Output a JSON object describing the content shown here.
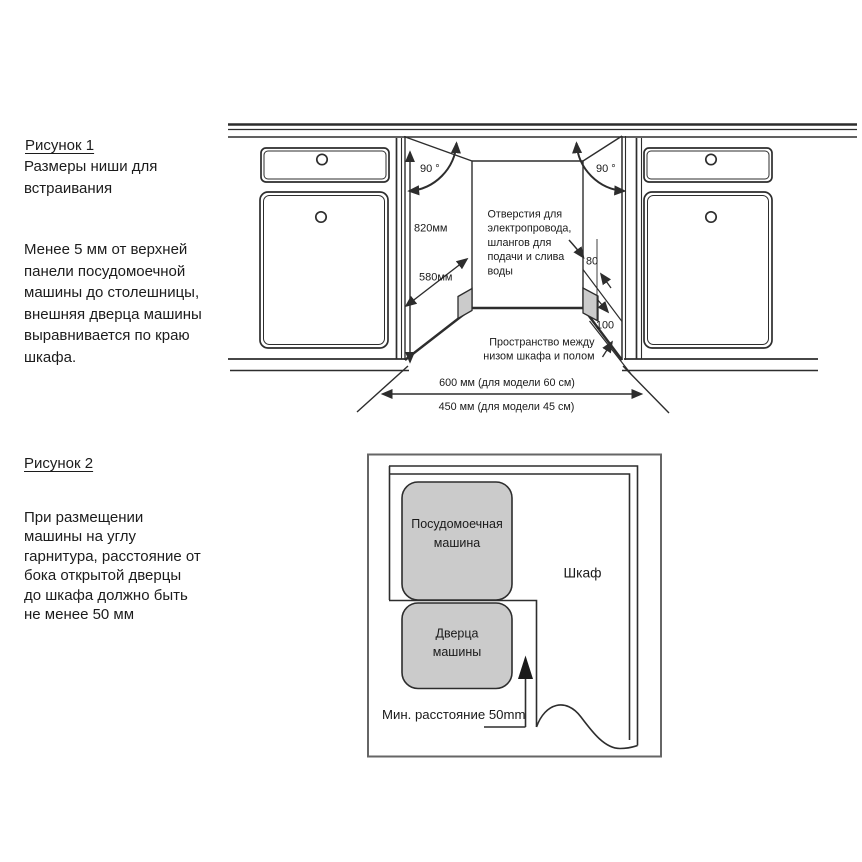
{
  "figure1": {
    "title": "Рисунок 1",
    "subtitle": [
      "Размеры ниши для",
      "встраивания"
    ],
    "caption": [
      "Менее 5 мм от верхней",
      "панели посудомоечной",
      "машины до столешницы,",
      "внешняя дверца машины",
      "выравнивается по краю",
      "шкафа."
    ],
    "angle_left": "90 °",
    "angle_right": "90 °",
    "dim_height": "820мм",
    "dim_depth": "580мм",
    "holes_note": [
      "Отверстия для",
      "электропровода,",
      "шлангов для",
      "подачи и слива",
      "воды"
    ],
    "dim_80": "80",
    "dim_100": "100",
    "floor_note": [
      "Пространство между",
      "низом шкафа и полом"
    ],
    "dim_600": "600 мм (для модели 60 см)",
    "dim_450": "450 мм (для модели 45 см)"
  },
  "figure2": {
    "title": "Рисунок 2",
    "caption": [
      "При размещении",
      "машины на углу",
      "гарнитура, расстояние от",
      "бока открытой дверцы",
      "до шкафа должно быть",
      "не менее 50 мм"
    ],
    "dishwasher": [
      "Посудомоечная",
      "машина"
    ],
    "door": [
      "Дверца",
      "машины"
    ],
    "cabinet": "Шкаф",
    "min_distance": "Мин. расстояние 50mm"
  },
  "colors": {
    "line": "#2d2d2d",
    "gray_fill": "#cbcbcb",
    "text": "#1a1a1a"
  }
}
